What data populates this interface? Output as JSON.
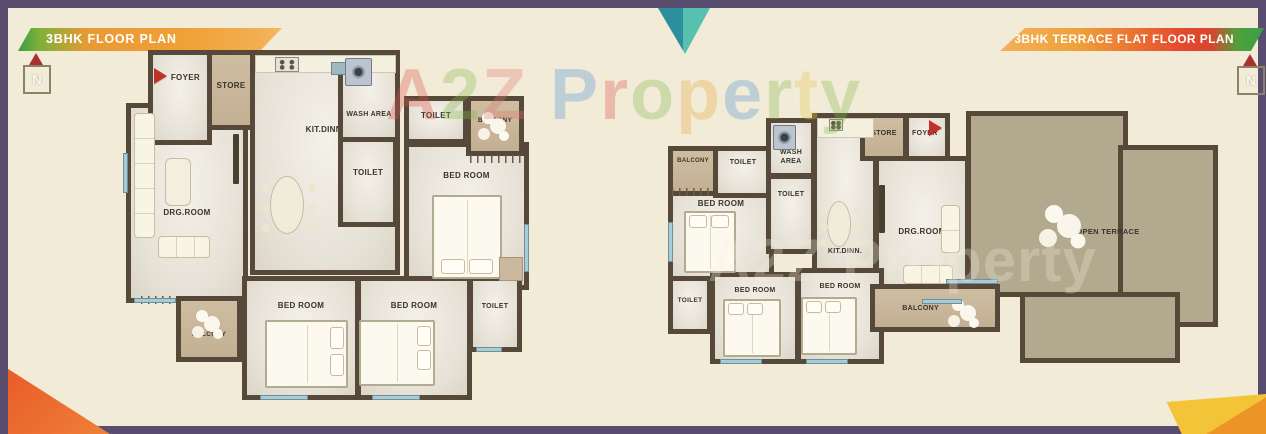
{
  "colors": {
    "frame": "#594d6f",
    "background": "#f2ebd8",
    "wall": "#57493a",
    "room_floor": "#e9e5da",
    "balcony_floor": "#c9b69a",
    "terrace_floor": "#b3a98f",
    "window_blue": "#a8ccd6",
    "banner_green": "#399e44",
    "banner_orange": "#ef9f35",
    "banner_red": "#e34b2f",
    "entry_arrow_red": "#c23128",
    "corner_orange": "#e85a28",
    "corner_yellow": "#f3c437",
    "corner_teal": "#2d8f9e"
  },
  "watermark": {
    "text": "A2Z Property",
    "letters": [
      {
        "ch": "A",
        "color": "#dd524c"
      },
      {
        "ch": "2",
        "color": "#83b84c"
      },
      {
        "ch": "Z",
        "color": "#e2766e"
      },
      {
        "ch": " ",
        "color": "#ffffff"
      },
      {
        "ch": "P",
        "color": "#4f93d2"
      },
      {
        "ch": "r",
        "color": "#dd524c"
      },
      {
        "ch": "o",
        "color": "#83b84c"
      },
      {
        "ch": "p",
        "color": "#e5a93e"
      },
      {
        "ch": "e",
        "color": "#4f93d2"
      },
      {
        "ch": "r",
        "color": "#83b84c"
      },
      {
        "ch": "t",
        "color": "#e5c84a"
      },
      {
        "ch": "y",
        "color": "#83b84c"
      }
    ]
  },
  "plans": {
    "left": {
      "title": "3BHK FLOOR PLAN",
      "compass": "N",
      "rooms": {
        "foyer": "FOYER",
        "store": "STORE",
        "kitdinn": "KIT.DINN.",
        "wash_area": "WASH AREA",
        "toilet_mid": "TOILET",
        "toilet_top": "TOILET",
        "balcony_top": "BALCONY",
        "bedroom_right": "BED ROOM",
        "drg_room": "DRG.ROOM",
        "balcony_bottom": "BALCONY",
        "bedroom_bottom_1": "BED ROOM",
        "bedroom_bottom_2": "BED ROOM",
        "toilet_bottom": "TOILET"
      }
    },
    "right": {
      "title": "3BHK TERRACE FLAT FLOOR PLAN",
      "compass": "N",
      "rooms": {
        "balcony_top": "BALCONY",
        "toilet_top": "TOILET",
        "wash_line1": "WASH",
        "wash_line2": "AREA",
        "toilet_mid": "TOILET",
        "store": "STORE",
        "foyer": "FOYER",
        "bedroom_left": "BED ROOM",
        "kitdinn": "KIT.DINN.",
        "drg_room": "DRG.ROOM",
        "toilet_bottom": "TOILET",
        "bedroom_bottom_1": "BED ROOM",
        "bedroom_bottom_2": "BED ROOM",
        "balcony_bottom": "BALCONY",
        "open_terrace": "OPEN TERRACE"
      }
    }
  }
}
